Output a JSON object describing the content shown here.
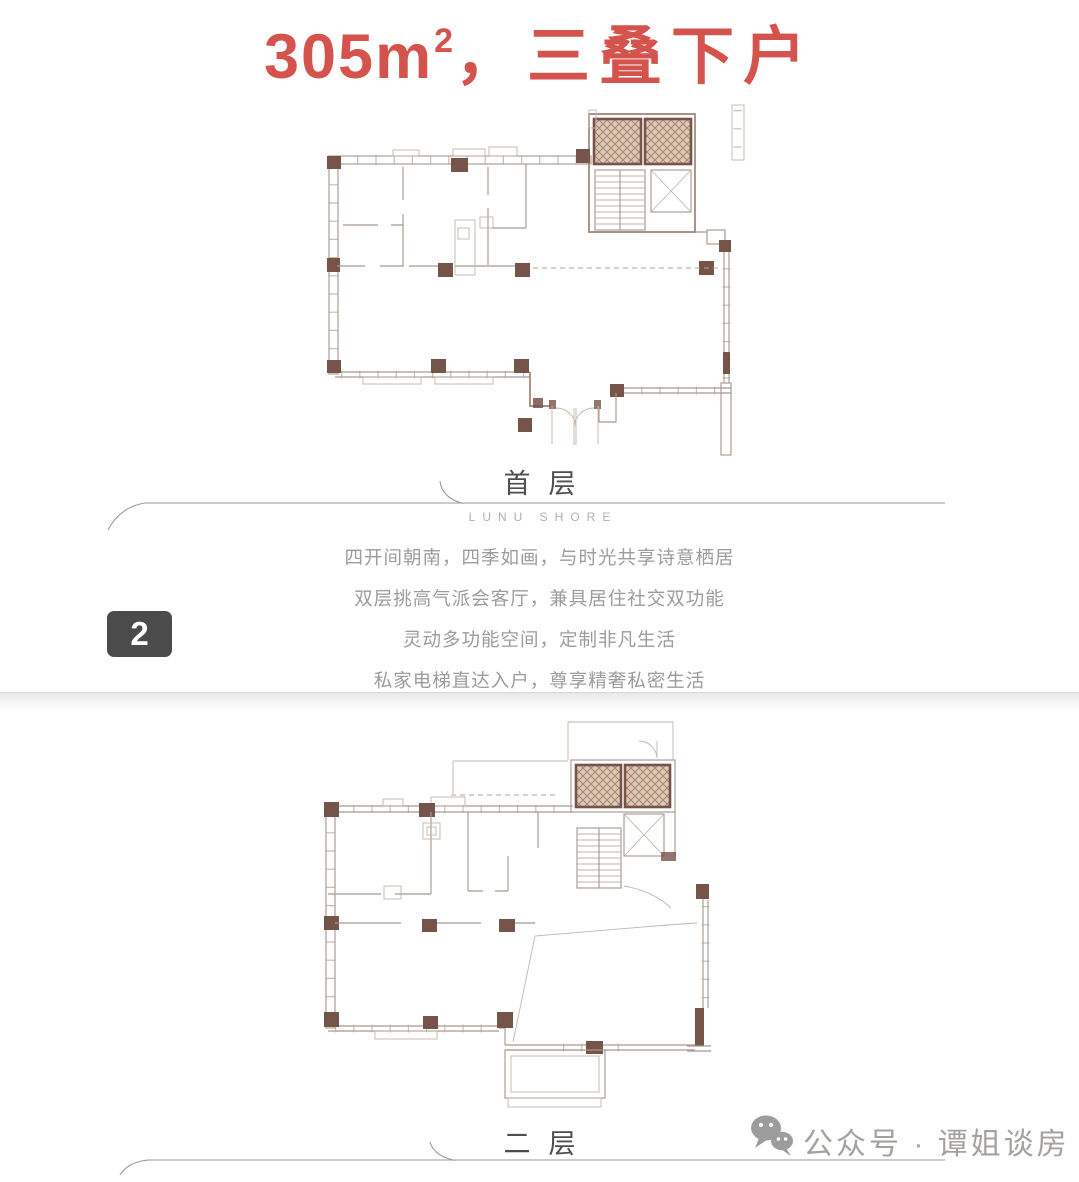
{
  "title": {
    "area_value": "305m",
    "superscript": "2",
    "suffix": "，三叠下户"
  },
  "first_floor": {
    "label": "首层",
    "brand": "LUNU SHORE",
    "description_lines": [
      "四开间朝南，四季如画，与时光共享诗意栖居",
      "双层挑高气派会客厅，兼具居住社交双功能",
      "灵动多功能空间，定制非凡生活",
      "私家电梯直达入户，尊享精奢私密生活"
    ]
  },
  "second_floor": {
    "label": "二层"
  },
  "page_badge": {
    "number": "2"
  },
  "footer": {
    "account_label": "公众号 · 谭姐谈房"
  },
  "colors": {
    "title_red": "#d4534c",
    "heading_gray": "#4e4e4e",
    "brand_gray": "#b5aea7",
    "text_gray": "#9c9c9c",
    "badge_bg": "#4b4b4b",
    "footer_gray": "#a5a19d",
    "wall_brown": "#9b8377",
    "wall_soft": "#a89a8e",
    "wall_faint": "#c3b5a9",
    "column_brown": "#77544a",
    "hatch_fill": "#ddc9b8",
    "hatch_line": "#a5846d",
    "tick_brown": "#b7a699",
    "dash_brown": "#b3a294",
    "divider_gray": "#d7d7d7"
  }
}
